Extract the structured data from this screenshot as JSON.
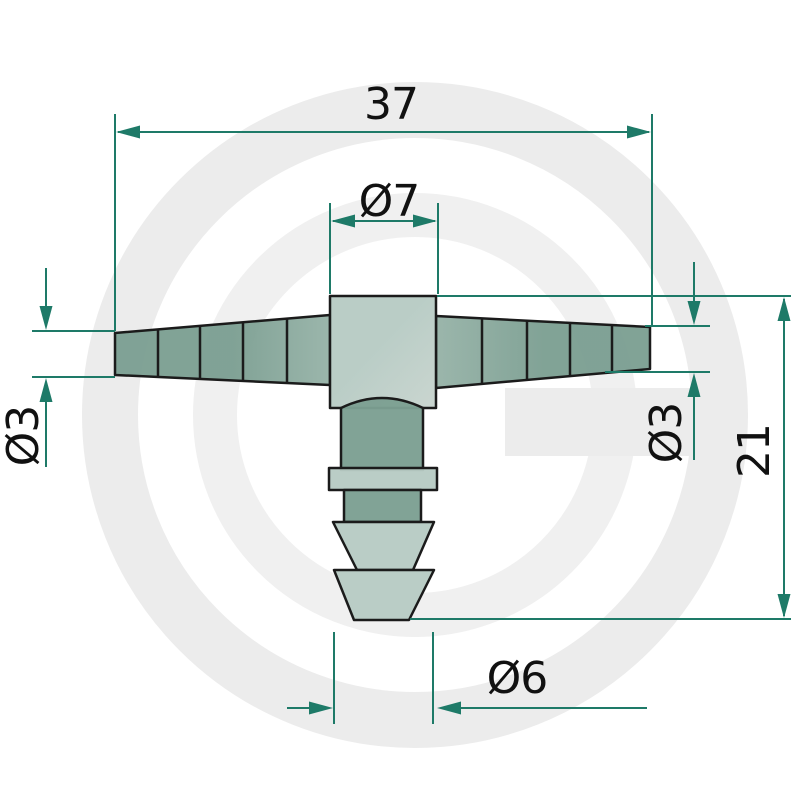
{
  "page": {
    "background": "#ffffff"
  },
  "watermark": {
    "glyph": "G",
    "ring_color": "#ececec",
    "inner_ring_color": "#f0f0f0"
  },
  "drawing": {
    "labels": {
      "overall_width": "37",
      "top_diameter": "Ø7",
      "left_diameter": "Ø3",
      "right_diameter": "Ø3",
      "side_height": "21",
      "bottom_diameter": "Ø6"
    },
    "colors": {
      "dimension": "#1e7a68",
      "outline": "#1b1b1b",
      "text": "#111111",
      "part_dark": "#7c9f92",
      "part_dark_lit": "#97b3a8",
      "part_light": "#b7cbc4",
      "part_light_lit": "#c8d4ce"
    }
  }
}
